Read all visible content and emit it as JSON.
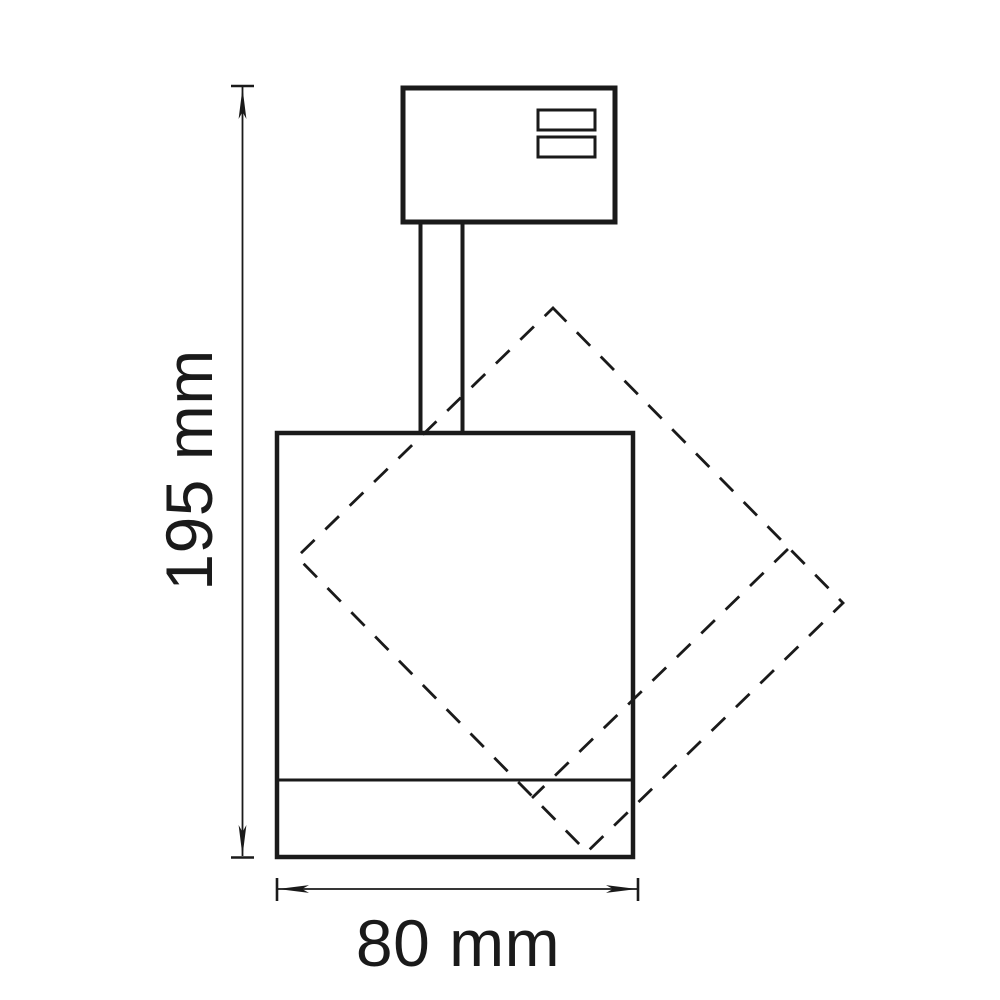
{
  "drawing": {
    "type": "technical-dimension-drawing",
    "subject": "track-spotlight-side-view",
    "height_dimension": {
      "label": "195 mm",
      "value_mm": 195,
      "orientation": "vertical"
    },
    "width_dimension": {
      "label": "80 mm",
      "value_mm": 80,
      "orientation": "horizontal"
    },
    "colors": {
      "line": "#1a1a1a",
      "background": "#ffffff"
    }
  }
}
